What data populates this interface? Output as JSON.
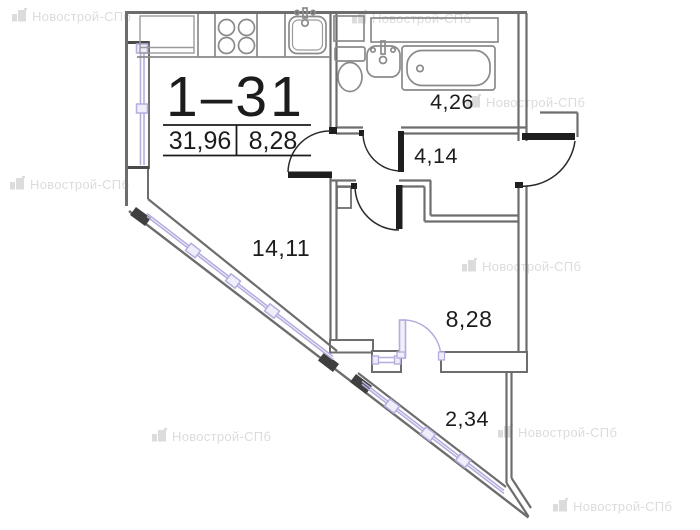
{
  "plan": {
    "unit_title": "1–31",
    "area_table": {
      "left_value": "31,96",
      "right_value": "8,28"
    },
    "rooms": {
      "bathroom": {
        "label": "4,26"
      },
      "hallway": {
        "label": "4,14"
      },
      "living_kitchen": {
        "label": "14,11"
      },
      "bedroom": {
        "label": "8,28"
      },
      "balcony": {
        "label": "2,34"
      }
    }
  },
  "watermark": {
    "text": "Новострой-СПб"
  },
  "colors": {
    "wall": "#6d6d6d",
    "fixture": "#8a8a8a",
    "door_leaf": "#1e1e1e",
    "window": "#b3aede",
    "window_fill": "#efeefb",
    "wall_cap": "#3f3f3f",
    "text": "#1c1c1c",
    "watermark": "#dcdcdc"
  }
}
